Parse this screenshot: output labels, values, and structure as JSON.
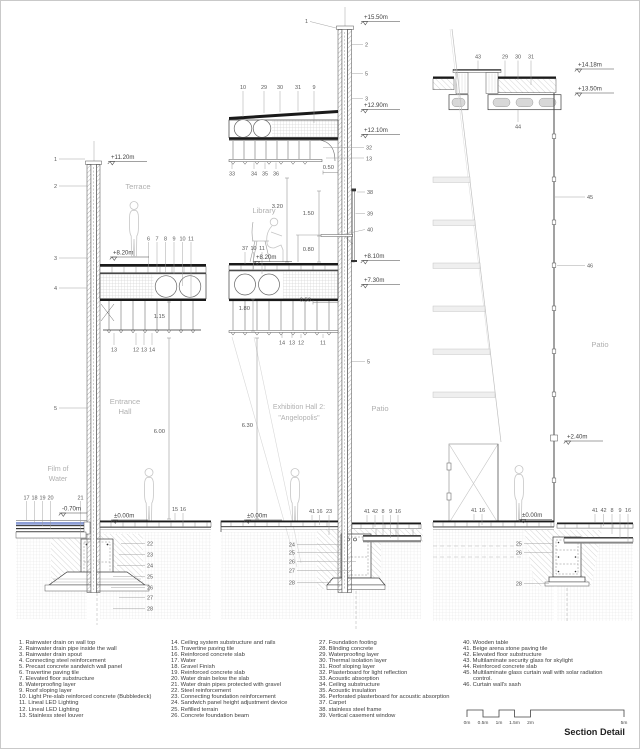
{
  "title": "Section Detail",
  "scalebar": [
    "0m",
    "0.5m",
    "1m",
    "1.5m",
    "2m",
    "5m"
  ],
  "legend": {
    "col1": [
      "1. Rainwater drain on wall top",
      "2. Rainwater drain pipe inside the wall",
      "3. Rainwater drain spout",
      "4. Connecting steel reinforcement",
      "5. Precast concrete sandwich wall panel",
      "6. Travertine paving tile",
      "7. Elevated floor substructure",
      "8. Waterproofing layer",
      "9. Roof sloping layer",
      "10. Light Pre-slab reinforced concrete (Bubbledeck)",
      "11. Lineal LED Lighting",
      "12. Lineal LED Lighting",
      "13. Stainless steel louver"
    ],
    "col2": [
      "14. Ceiling system substructure and rails",
      "15. Travertine paving tile",
      "16. Reinforced concrete slab",
      "17. Water",
      "18. Gravel Finish",
      "19. Reinforced concrete slab",
      "20. Water drain below the slab",
      "21. Water drain pipes protected with gravel",
      "22. Steel reinforcement",
      "23. Connecting foundation reinforcement",
      "24. Sandwich panel height adjustment device",
      "25. Refilled terrain",
      "26. Concrete foundation beam"
    ],
    "col3": [
      "27. Foundation footing",
      "28. Blinding concrete",
      "29. Waterproofing layer",
      "30. Thermal isolation layer",
      "31. Roof sloping layer",
      "32. Plasterboard for light reflection",
      "33. Acoustic absorption",
      "34. Ceiling substructure",
      "35. Acoustic insulation",
      "36. Perforated plasterboard for acoustic absorption",
      "37. Carpet",
      "38. stainless steel frame",
      "39. Vertical casement window"
    ],
    "col4": [
      "40. Wooden table",
      "41. Beige arena stone paving tile",
      "42. Elevated floor substructure",
      "43. Multilaminate security glass for skylight",
      "44. Reinforced concrete slab",
      "45. Multilaminate glass curtain wall with solar radiation control.",
      "46. Curtain wall's sash"
    ]
  },
  "s1": {
    "elev_top": "+11.20m",
    "room_terrace": "Terrace",
    "elev_floor": "+8.20m",
    "wall_callouts": [
      "1",
      "2",
      "3",
      "4",
      "5"
    ],
    "floor_row": [
      "6",
      "7",
      "8",
      "9",
      "10",
      "11"
    ],
    "ceil_row": [
      "13",
      "12",
      "13",
      "14"
    ],
    "dim_ceiling": "1.15",
    "dim_hall": "6.00",
    "room_hall_1": "Entrance",
    "room_hall_2": "Hall",
    "room_water_1": "Film of",
    "room_water_2": "Water",
    "water_row": [
      "17",
      "18",
      "19",
      "20"
    ],
    "c21": "21",
    "elev_water": "-0.70m",
    "elev_ground": "±0.00m",
    "paving_row": [
      "15",
      "16"
    ],
    "found_col": [
      "22",
      "23",
      "24",
      "25",
      "26",
      "27",
      "28"
    ]
  },
  "s2": {
    "c1": "1",
    "elev_top": "+15.50m",
    "wall_right_col": [
      "2",
      "5",
      "3"
    ],
    "roof_row": [
      "10",
      "29",
      "30",
      "31",
      "9"
    ],
    "elev_roof": "+12.90m",
    "elev_roof2": "+12.10m",
    "c32": "32",
    "c13": "13",
    "ceil_row": [
      "33",
      "34",
      "35",
      "36"
    ],
    "dim_ceiling": "0.50",
    "room_library": "Library",
    "dim_library": "3.20",
    "dim_window": "1.50",
    "dim_sill": "0.80",
    "win_col": [
      "38",
      "39",
      "40"
    ],
    "floor_row": [
      "37",
      "10",
      "11"
    ],
    "elev_floor": "+8.20m",
    "elev_floor_r": "+8.10m",
    "elev_slab_r": "+7.30m",
    "dim_180": "1.80",
    "dim_050": "0.50",
    "ceil2_row": [
      "14",
      "13",
      "12",
      "11"
    ],
    "c5": "5",
    "room_hall_1": "Exhibition Hall 2:",
    "room_hall_2": "\"Angelopolis\"",
    "room_patio": "Patio",
    "dim_hall": "6.30",
    "elev_ground": "±0.00m",
    "ground_left_row": [
      "41",
      "16",
      "23"
    ],
    "ground_right_row": [
      "41",
      "42",
      "8",
      "9",
      "16"
    ],
    "found_col": [
      "24",
      "25",
      "26",
      "27",
      "28"
    ]
  },
  "s3": {
    "top_row": [
      "43",
      "29",
      "30",
      "31"
    ],
    "elev_top": "+14.18m",
    "elev_top2": "+13.50m",
    "c44": "44",
    "c45": "45",
    "c46": "46",
    "room_patio": "Patio",
    "elev_mid": "+2.40m",
    "elev_ground": "±0.00m",
    "ground_left_row": [
      "41",
      "16"
    ],
    "ground_right_row": [
      "41",
      "42",
      "8",
      "9",
      "16"
    ],
    "found_col": [
      "25",
      "26",
      "28"
    ]
  }
}
